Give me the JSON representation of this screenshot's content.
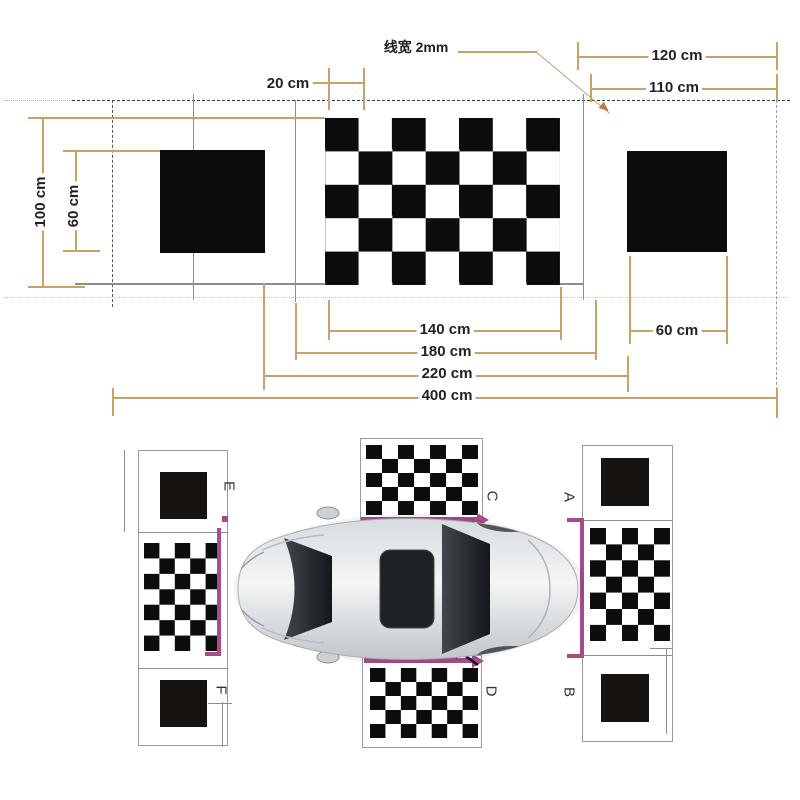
{
  "top_diagram": {
    "note_label": "线宽 2mm",
    "dims": {
      "d20": "20 cm",
      "d120": "120 cm",
      "d110": "110 cm",
      "d100": "100 cm",
      "d60_left": "60 cm",
      "d140": "140 cm",
      "d60_right": "60 cm",
      "d180": "180 cm",
      "d220": "220 cm",
      "d400": "400 cm"
    },
    "checkerboard": {
      "cols": 7,
      "rows": 5
    },
    "black_squares": 2
  },
  "bottom_diagram": {
    "board_labels": {
      "rear_top": "A",
      "rear_bottom": "B",
      "top_center": "C",
      "bottom_center": "D",
      "front_top": "E",
      "front_bottom": "F"
    },
    "checkerboards": {
      "left_side": {
        "cols": 5,
        "rows": 7
      },
      "right_side": {
        "cols": 5,
        "rows": 7
      },
      "top_center": {
        "cols": 7,
        "rows": 5
      },
      "bottom_center": {
        "cols": 7,
        "rows": 5
      }
    }
  },
  "colors": {
    "dimension_line": "#c8a269",
    "magenta_marker": "#a84a8c",
    "pattern_black": "#0c0c0c"
  }
}
